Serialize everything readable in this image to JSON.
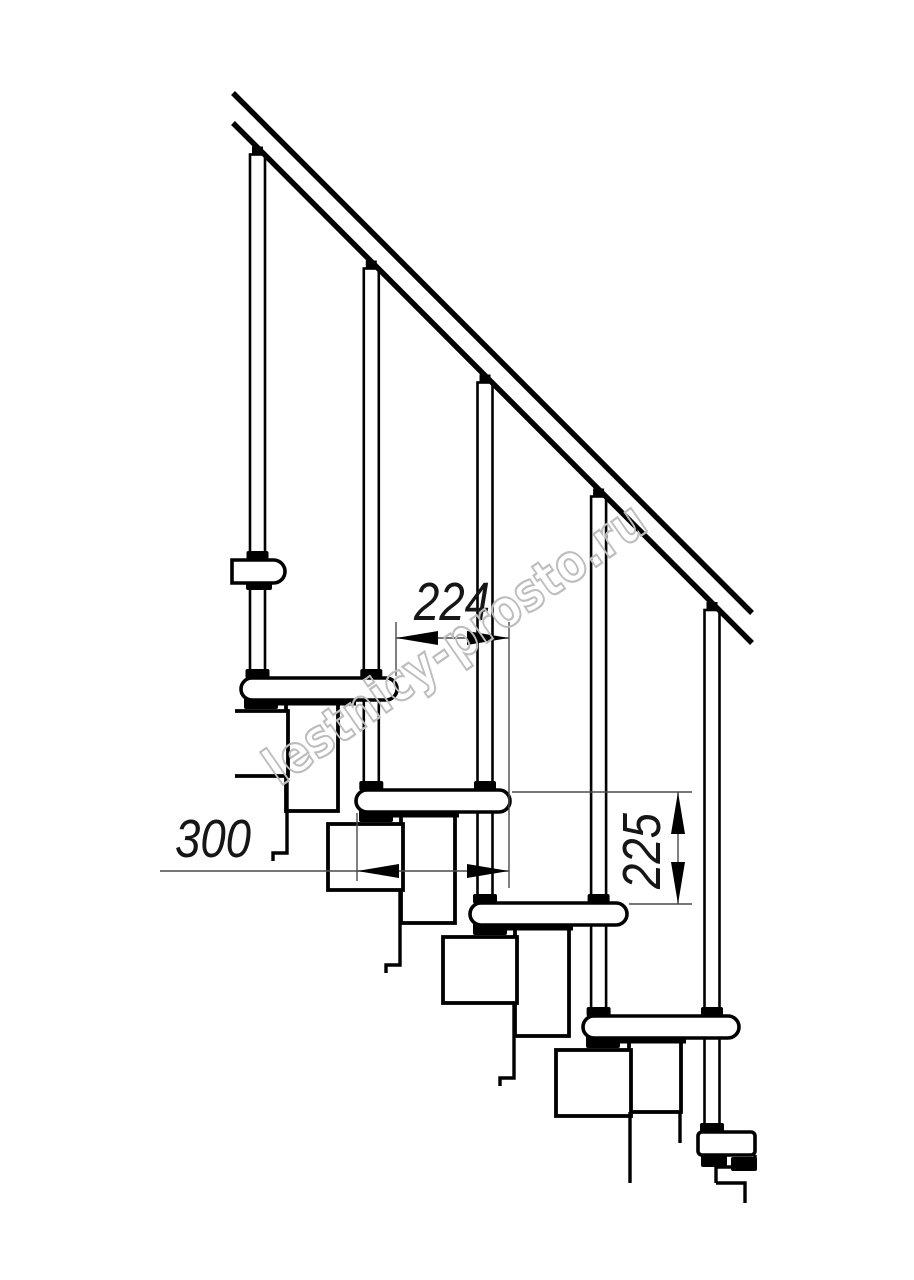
{
  "page": {
    "background": "#ffffff",
    "width": 914,
    "height": 1280
  },
  "watermark": {
    "text": "lestnicy-prosto.ru",
    "color": "#bdbdbd",
    "angle_deg": -34.8,
    "cx": 455,
    "cy": 643,
    "font_size": 52,
    "text_length": 452,
    "stroke_width": 2.2
  },
  "dimensions": [
    {
      "id": "step-run-224",
      "label": "224",
      "orientation": "horizontal",
      "line": {
        "x1": 396,
        "y": 638,
        "x2": 509
      },
      "arrows": [
        {
          "x": 396,
          "y": 638,
          "dir": "left"
        },
        {
          "x": 509,
          "y": 638,
          "dir": "right"
        }
      ],
      "extensions": [
        {
          "x1": 396,
          "y1": 622,
          "x2": 396,
          "y2": 676
        },
        {
          "x1": 509,
          "y1": 622,
          "x2": 509,
          "y2": 888
        }
      ],
      "text": {
        "x": 452,
        "y": 620,
        "rotate": 0
      }
    },
    {
      "id": "tread-depth-300",
      "label": "300",
      "orientation": "horizontal",
      "line": {
        "x1": 160,
        "y": 871,
        "x2": 509
      },
      "arrows": [
        {
          "x": 357,
          "y": 871,
          "dir": "left"
        },
        {
          "x": 509,
          "y": 871,
          "dir": "right"
        }
      ],
      "extensions": [
        {
          "x1": 357,
          "y1": 813,
          "x2": 357,
          "y2": 881
        }
      ],
      "text": {
        "x": 213,
        "y": 857,
        "rotate": 0
      }
    },
    {
      "id": "step-rise-225",
      "label": "225",
      "orientation": "vertical",
      "line": {
        "x": 678,
        "y1": 792,
        "y2": 904
      },
      "arrows": [
        {
          "x": 678,
          "y": 792,
          "dir": "up"
        },
        {
          "x": 678,
          "y": 904,
          "dir": "down"
        }
      ],
      "extensions": [
        {
          "x1": 512,
          "y1": 792,
          "x2": 692,
          "y2": 792
        },
        {
          "x1": 629,
          "y1": 904,
          "x2": 692,
          "y2": 904
        }
      ],
      "text": {
        "x": 660,
        "y": 851,
        "rotate": -90
      }
    }
  ],
  "drawing": {
    "handrail": {
      "upper": [
        233,
        93,
        752,
        613
      ],
      "lower": [
        233,
        123,
        752,
        643
      ],
      "stroke_width": 5.5
    },
    "baluster_width": 15,
    "balusters": [
      {
        "cx": 257.5,
        "rail_y": 147.5
      },
      {
        "cx": 371.3,
        "rail_y": 261.5
      },
      {
        "cx": 485.0,
        "rail_y": 375.5
      },
      {
        "cx": 598.6,
        "rail_y": 489.5
      },
      {
        "cx": 712.0,
        "rail_y": 603.0
      }
    ],
    "treads": [
      {
        "x": 232,
        "y": 560,
        "w": 53,
        "h": 23,
        "left_square": true
      },
      {
        "x": 241,
        "y": 678,
        "w": 156,
        "h": 22
      },
      {
        "x": 356,
        "y": 790,
        "w": 154,
        "h": 22
      },
      {
        "x": 470,
        "y": 903,
        "w": 157,
        "h": 22
      },
      {
        "x": 583,
        "y": 1016,
        "w": 156,
        "h": 22
      },
      {
        "x": 698,
        "y": 1132,
        "w": 57,
        "h": 23,
        "small_r": true
      }
    ],
    "modules": {
      "v_boxes": [
        [
          286,
          701,
          52,
          110
        ],
        [
          401,
          814,
          54,
          109
        ],
        [
          515,
          927,
          54,
          109
        ],
        [
          629,
          1040,
          52,
          72
        ]
      ],
      "u_boxes": [
        [
          235,
          711,
          53,
          65,
          true
        ],
        [
          328,
          824,
          75,
          66
        ],
        [
          443,
          937,
          74,
          66
        ],
        [
          556,
          1050,
          75,
          66
        ]
      ],
      "tails": [
        "M287,776 V853 H273 V861",
        "M400,890 V965 H386 V973",
        "M514,1003 V1078 H500 V1086",
        "M630,1112 V1183",
        "M680,1112 V1143"
      ],
      "bottom_steps": "M755,1155 V1167 M716,1167 H757 M716,1167 V1183 M716,1183 H745 V1203"
    },
    "under_marks": [
      [
        246,
        582,
        26,
        8
      ],
      [
        244,
        699,
        34,
        10
      ],
      [
        359,
        811,
        34,
        11
      ],
      [
        473,
        924,
        34,
        11
      ],
      [
        586,
        1037,
        34,
        11
      ],
      [
        701,
        1154,
        26,
        13
      ],
      [
        731,
        1157,
        26,
        14
      ]
    ],
    "under_strips": [
      [
        244,
        699,
        112,
        6.5
      ],
      [
        359,
        811,
        100,
        6.5
      ],
      [
        473,
        924,
        100,
        6.5
      ],
      [
        586,
        1037,
        100,
        6.5
      ]
    ],
    "colors": {
      "line": "#000000",
      "dim": "#4a4a4a",
      "fill": "#ffffff"
    }
  }
}
